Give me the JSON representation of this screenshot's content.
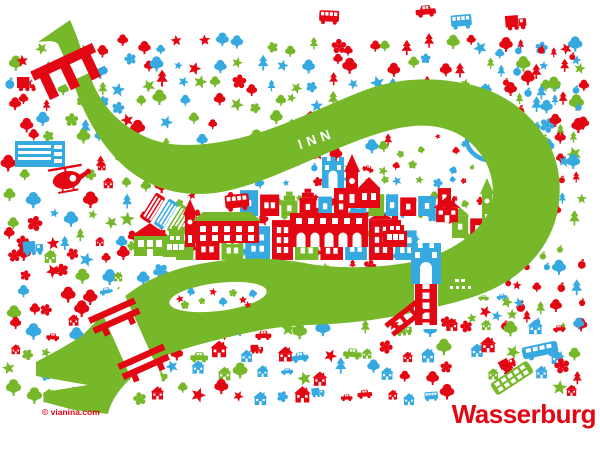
{
  "map": {
    "title": "Wasserburg",
    "river_label": "INN",
    "copyright": "© vianina.com",
    "colors": {
      "red": "#e30613",
      "blue": "#36a9e1",
      "green": "#76b82a",
      "white": "#ffffff"
    },
    "color_weights": {
      "red": 0.38,
      "blue": 0.31,
      "green": 0.31
    },
    "seed": 12,
    "river": {
      "path": "M38,42 L70,20 C80,42 84,60 90,76 C100,104 118,124 146,137 C172,149 205,146 240,138 C278,129 320,108 360,92 C395,78 430,76 468,84 C505,92 532,114 548,142 C560,164 563,190 556,218 C548,248 526,272 497,287 C472,300 443,305 415,312 C390,318 350,324 310,325 C272,326 240,334 205,343 C178,350 155,358 138,372 C127,381 112,396 108,414 L74,410 L44,402 L44,392 L88,385 L36,376 L36,362 L60,349 L82,336 C95,322 112,305 132,291 C152,277 175,268 205,263 C240,257 275,257 310,264 C340,269 380,268 412,262 C440,256 468,242 484,220 C497,201 495,175 482,156 C470,138 452,128 430,126 C400,123 362,138 325,154 C288,170 250,188 215,193 C180,197 150,188 126,168 C104,149 88,122 78,96 C70,72 64,56 58,44 C54,40 46,41 38,42 Z",
      "island": {
        "cx": 218,
        "cy": 297,
        "rx": 49,
        "ry": 14,
        "rot": -7
      },
      "label_x": 318,
      "label_y": 143,
      "label_rot": -19
    },
    "bridges": [
      {
        "name": "north-bridge",
        "x": 67,
        "y": 70,
        "rot": -25,
        "gap_w": 72,
        "gap_h": 24,
        "style": "comb"
      },
      {
        "name": "west-bridge",
        "x": 129,
        "y": 339,
        "rot": -24,
        "gap_w": 28,
        "gap_h": 100,
        "style": "double"
      },
      {
        "name": "inn-bridge",
        "x": 426,
        "y": 299,
        "rot": 0,
        "gap_w": 24,
        "gap_h": 60,
        "style": "ladder"
      }
    ],
    "peninsula": [
      [
        130,
        205
      ],
      [
        215,
        192
      ],
      [
        300,
        170
      ],
      [
        380,
        146
      ],
      [
        448,
        118
      ],
      [
        478,
        131
      ],
      [
        503,
        160
      ],
      [
        507,
        196
      ],
      [
        486,
        228
      ],
      [
        444,
        252
      ],
      [
        360,
        263
      ],
      [
        250,
        262
      ],
      [
        165,
        267
      ],
      [
        132,
        248
      ]
    ],
    "exclusions": [
      [
        14,
        138,
        54,
        30
      ],
      [
        44,
        158,
        46,
        46
      ],
      [
        455,
        396,
        145,
        54
      ],
      [
        28,
        400,
        95,
        28
      ]
    ],
    "zones": [
      {
        "name": "top-field",
        "x": 10,
        "y": 46,
        "w": 582,
        "h": 116,
        "step": 19,
        "smin": 9,
        "smax": 16,
        "mix": {
          "tree": 40,
          "pine": 22,
          "star": 16,
          "flower": 14,
          "fruit": 4,
          "house": 4
        }
      },
      {
        "name": "left-field",
        "x": 10,
        "y": 162,
        "w": 158,
        "h": 168,
        "step": 19,
        "smin": 9,
        "smax": 16,
        "mix": {
          "tree": 28,
          "pine": 10,
          "star": 22,
          "flower": 22,
          "house": 12,
          "car": 6
        }
      },
      {
        "name": "mid-field",
        "x": 168,
        "y": 162,
        "w": 262,
        "h": 118,
        "step": 20,
        "smin": 8,
        "smax": 14,
        "mix": {
          "tree": 30,
          "star": 25,
          "flower": 25,
          "pine": 10,
          "fruit": 10
        }
      },
      {
        "name": "right-field",
        "x": 505,
        "y": 52,
        "w": 88,
        "h": 286,
        "step": 18,
        "smin": 9,
        "smax": 15,
        "mix": {
          "fruit": 38,
          "pine": 24,
          "tree": 20,
          "star": 18
        }
      },
      {
        "name": "bottom-field",
        "x": 10,
        "y": 330,
        "w": 575,
        "h": 72,
        "step": 21,
        "smin": 10,
        "smax": 17,
        "mix": {
          "house": 34,
          "tree": 16,
          "star": 18,
          "flower": 14,
          "car": 8,
          "pine": 4,
          "truck": 3,
          "bus": 3
        }
      },
      {
        "name": "riverside-cars",
        "x": 432,
        "y": 300,
        "w": 86,
        "h": 32,
        "step": 17,
        "smin": 9,
        "smax": 13,
        "mix": {
          "car": 50,
          "star": 25,
          "flower": 25
        }
      },
      {
        "name": "top-vehicles",
        "x": 60,
        "y": 14,
        "w": 500,
        "h": 28,
        "step": 46,
        "smin": 16,
        "smax": 23,
        "keep": 0.6,
        "mix": {
          "car": 45,
          "truck": 30,
          "bus": 25
        }
      }
    ],
    "peninsula_filler": {
      "step": 17,
      "smin": 6,
      "smax": 11,
      "mix": {
        "tree": 30,
        "star": 28,
        "flower": 28,
        "fruit": 10,
        "car": 4
      }
    },
    "town_rows": [
      {
        "y": 260,
        "x0": 176,
        "x1": 412,
        "hmin": 26,
        "hmax": 46,
        "wmin": 15,
        "wmax": 25
      },
      {
        "y": 216,
        "x0": 240,
        "x1": 450,
        "hmin": 15,
        "hmax": 30,
        "wmin": 12,
        "wmax": 20
      },
      {
        "y": 238,
        "x0": 452,
        "x1": 508,
        "hmin": 18,
        "hmax": 32,
        "wmin": 12,
        "wmax": 17
      }
    ],
    "landmarks": [
      {
        "type": "parking",
        "x": 40,
        "y": 154,
        "color": "blue"
      },
      {
        "type": "helicopter",
        "x": 67,
        "y": 180,
        "rot": -10,
        "s": 34,
        "color": "red"
      },
      {
        "type": "truck",
        "x": 27,
        "y": 83,
        "s": 20,
        "color": "red"
      },
      {
        "type": "truck",
        "x": 45,
        "y": 86,
        "s": 11,
        "color": "green"
      },
      {
        "type": "truck",
        "x": 33,
        "y": 247,
        "s": 20,
        "rot": -4,
        "color": "blue"
      },
      {
        "type": "tiltbus",
        "x": 153,
        "y": 208,
        "rot": -58,
        "color": "red"
      },
      {
        "type": "tiltbus",
        "x": 166,
        "y": 214,
        "rot": -58,
        "color": "blue"
      },
      {
        "type": "tiltbus",
        "x": 179,
        "y": 220,
        "rot": -58,
        "color": "green"
      },
      {
        "type": "bus",
        "x": 237,
        "y": 201,
        "s": 24,
        "rot": -6,
        "color": "red"
      },
      {
        "type": "housegable",
        "x": 150,
        "y": 240,
        "color": "green"
      },
      {
        "type": "stepped",
        "x": 175,
        "y": 243,
        "color": "green"
      },
      {
        "type": "churchsmall",
        "x": 190,
        "y": 229,
        "color": "red"
      },
      {
        "type": "longbuilding",
        "x": 227,
        "y": 232,
        "color": "red"
      },
      {
        "type": "arcade",
        "x": 329,
        "y": 230,
        "color": "red"
      },
      {
        "type": "church",
        "x": 352,
        "y": 190,
        "color": "red"
      },
      {
        "type": "gatesmall",
        "x": 333,
        "y": 174,
        "color": "blue"
      },
      {
        "type": "stepped",
        "x": 395,
        "y": 233,
        "color": "red"
      },
      {
        "type": "redgable",
        "x": 447,
        "y": 210,
        "color": "red"
      },
      {
        "type": "churchsmall",
        "x": 487,
        "y": 208,
        "color": "green"
      },
      {
        "type": "towerblue",
        "x": 505,
        "y": 207,
        "color": "blue"
      },
      {
        "type": "stadium",
        "x": 482,
        "y": 147,
        "rot": 35,
        "color": "blue"
      },
      {
        "type": "gate",
        "x": 426,
        "y": 264,
        "color": "blue",
        "overlay": true
      },
      {
        "type": "boat",
        "x": 463,
        "y": 286,
        "color": "green",
        "overlay": true
      },
      {
        "type": "tiltbusL",
        "x": 540,
        "y": 350,
        "rot": -12,
        "color": "blue",
        "overlay": true
      },
      {
        "type": "busgrid",
        "x": 512,
        "y": 378,
        "rot": -33,
        "color": "green",
        "overlay": true
      },
      {
        "type": "truck",
        "x": 507,
        "y": 363,
        "s": 16,
        "rot": -28,
        "color": "red",
        "overlay": true
      }
    ],
    "island_icons": [
      {
        "dx": -38,
        "dy": 2,
        "t": "star"
      },
      {
        "dx": -27,
        "dy": -5,
        "t": "tree"
      },
      {
        "dx": -16,
        "dy": 4,
        "t": "flower"
      },
      {
        "dx": -5,
        "dy": -5,
        "t": "star"
      },
      {
        "dx": 5,
        "dy": 5,
        "t": "tree"
      },
      {
        "dx": 15,
        "dy": -4,
        "t": "flower"
      },
      {
        "dx": 25,
        "dy": 3,
        "t": "star"
      },
      {
        "dx": 35,
        "dy": -3,
        "t": "tree"
      },
      {
        "dx": -33,
        "dy": 8,
        "t": "flower"
      },
      {
        "dx": 30,
        "dy": 8,
        "t": "star"
      }
    ]
  }
}
